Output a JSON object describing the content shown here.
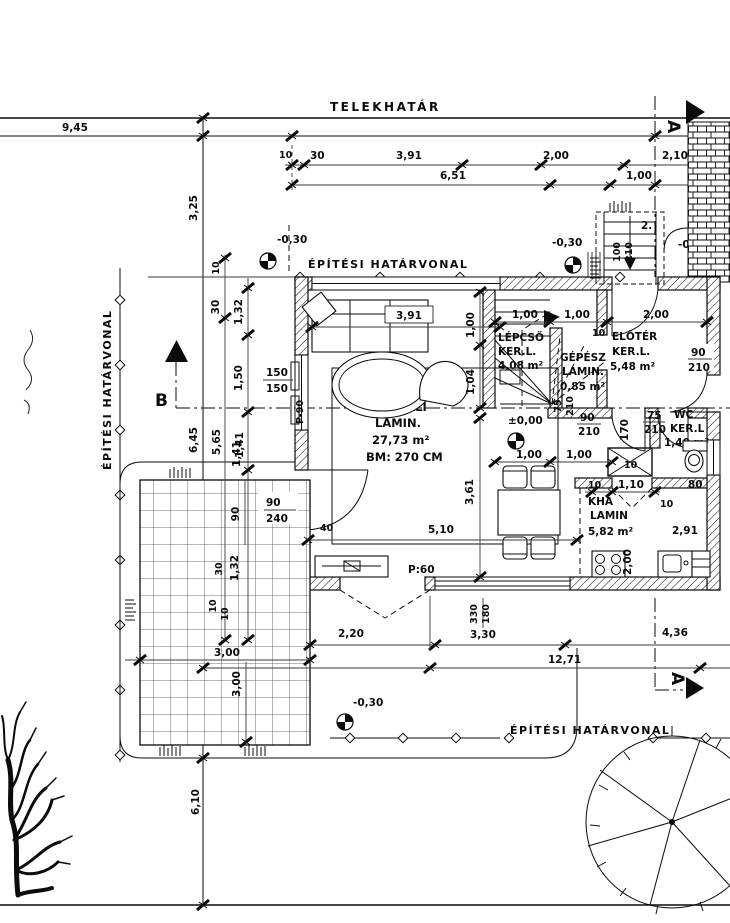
{
  "labels": {
    "telekhatar": "TELEKHATÁR",
    "eh_top": "ÉPÍTÉSI HATÁRVONAL",
    "eh_left": "ÉPÍTÉSI HATÁRVONAL",
    "eh_bottom": "ÉPÍTÉSI HATÁRVONAL",
    "p90": "P-90",
    "p60": "P:60",
    "step_note": "2.",
    "section_a_top": "A",
    "section_a_bottom": "A",
    "section_b": "B"
  },
  "levels": {
    "m030_left": "-0,30",
    "m030_right": "-0,30",
    "m030_bottom": "-0,30",
    "m010_entry": "-0,10",
    "pm000_hall": "±0,00",
    "pm000_terasz": "±0,00"
  },
  "rooms": {
    "nappali": [
      "NAPPALI",
      "LAMIN.",
      "27,73 m²",
      "BM: 270 CM"
    ],
    "lepcso": [
      "LÉPCSŐ",
      "KER.L.",
      "4,08 m²"
    ],
    "gepesz": [
      "GÉPÉSZ",
      "LAMIN.",
      "0,85 m²"
    ],
    "eloter": [
      "ELŐTÉR",
      "KER.L.",
      "5,48 m²"
    ],
    "wc": [
      "WC",
      "KER.L",
      "1,40 m²"
    ],
    "kha": [
      "KHA",
      "LAMIN",
      "5,82 m²"
    ],
    "terasz": [
      "TERASZ",
      "KER.LAP",
      "16,21 m²"
    ]
  },
  "dims": {
    "d945": "9,45",
    "d325": "3,25",
    "d10t": "10",
    "d30t": "30",
    "d391t": "3,91",
    "d200t": "2,00",
    "d210t": "2,10",
    "d651": "6,51",
    "d100t": "1,00",
    "d155": "1,55",
    "d10l": "10",
    "d30l": "30",
    "d132l": "1,32",
    "d150l": "1,50",
    "w150a": "150",
    "w150b": "150",
    "d645": "6,45",
    "d565": "5,65",
    "d141l": "1,41",
    "d391s": "3,91",
    "d100r": "1,00",
    "d104": "1,04",
    "d100s1": "1,00",
    "d100s2": "1,00",
    "d200e": "2,00",
    "d10e": "10",
    "w90a": "90",
    "w210a": "210",
    "w75r": "75",
    "w210r": "210",
    "w90b": "90",
    "w210b": "210",
    "d170": "170",
    "w75wc": "75",
    "w210wc": "210",
    "d10sh": "10",
    "d100h1": "1,00",
    "d100h2": "1,00",
    "w100e": "100",
    "w210e": "210",
    "d10k1": "10",
    "d110": "1,10",
    "d10k2": "10",
    "d80": "80",
    "d291": "2,91",
    "d200k": "2,00",
    "d40": "40",
    "d510": "5,10",
    "d361": "3,61",
    "d10b": "10",
    "d220": "2,20",
    "d300a": "3,00",
    "d300b": "3,00",
    "d330v": "330",
    "d180v": "180",
    "d330": "3,30",
    "d436": "4,36",
    "d1271": "12,71",
    "d610": "6,10",
    "d90tr": "90",
    "w90t": "90",
    "w240t": "240",
    "d132t": "1,32",
    "d30tr": "30",
    "d10tr": "10",
    "d141t": "1,41"
  }
}
